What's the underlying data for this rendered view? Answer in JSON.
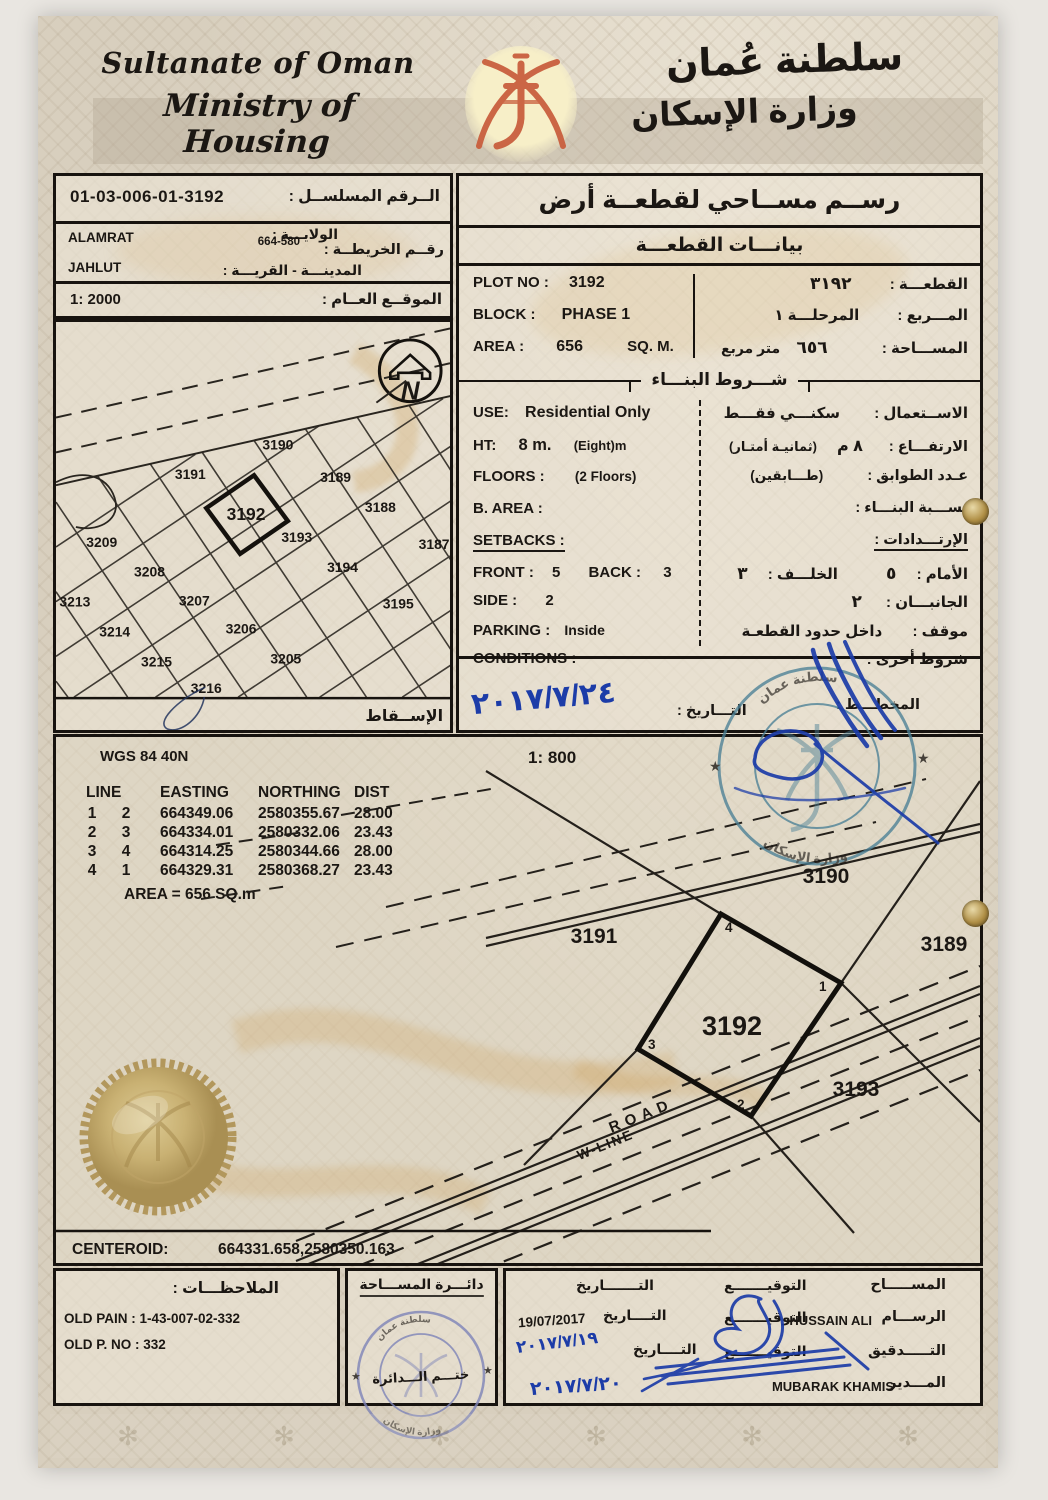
{
  "decor": {
    "star": "★",
    "watermark_glyph": "✻"
  },
  "header": {
    "en_line1": "Sultanate of Oman",
    "en_line2": "Ministry of Housing",
    "ar_line1": "سلطنة عُمان",
    "ar_line2": "وزارة الإسكان"
  },
  "serial_box": {
    "serial_value": "01-03-006-01-3192",
    "serial_label": "الــرقم المسلســل :",
    "wilaya_value": "ALAMRAT",
    "wilaya_label": "الولايـــة :",
    "map_value": "664-580",
    "map_label": "رقــم الخريطــة :",
    "city_value": "JAHLUT",
    "city_label": "المدينـــة - القريـــة :",
    "site_value": "1: 2000",
    "site_label": "الموقــع العــام :"
  },
  "location_map": {
    "plots": [
      "3190",
      "3191",
      "3189",
      "3192",
      "3188",
      "3209",
      "3193",
      "3187",
      "3208",
      "3194",
      "3213",
      "3207",
      "3195",
      "3214",
      "3206",
      "3215",
      "3205",
      "3216"
    ],
    "north": "N",
    "projection_label": "الإســقاط"
  },
  "plot_info": {
    "title": "رســم مســاحي لقطعــة أرض",
    "subtitle": "بيانـــات القطعـــة",
    "plot_no_label": "PLOT NO :",
    "plot_no_value": "3192",
    "plot_ar_label": "القطعـــة :",
    "plot_ar_value": "٣١٩٢",
    "block_label": "BLOCK :",
    "block_value": "PHASE 1",
    "block_ar_label": "المـــربع :",
    "block_ar_value": "المرحلـــة ١",
    "area_label": "AREA :",
    "area_value": "656",
    "area_unit": "SQ. M.",
    "area_ar_label": "المســـاحة :",
    "area_ar_value": "٦٥٦",
    "area_ar_unit": "متر مربع",
    "conditions_title": "شـــروط البنـــاء",
    "use_label": "USE:",
    "use_value": "Residential Only",
    "use_ar_label": "الاســتعمال :",
    "use_ar_value": "سكنـــي فقـــط",
    "ht_label": "HT:",
    "ht_value": "8 m.",
    "ht_note": "(Eight)m",
    "ht_ar_label": "الارتفـــاع :",
    "ht_ar_value": "٨ م",
    "ht_ar_note": "(ثمانيـة أمتـار)",
    "floors_label": "FLOORS :",
    "floors_value": "(2 Floors)",
    "floors_ar_label": "عـدد الطوابق :",
    "floors_ar_value": "(طـــابقين)",
    "barea_label": "B. AREA :",
    "barea_ar_label": "نســـبة البنـــاء :",
    "setbacks_label": "SETBACKS :",
    "setbacks_ar_label": "الإرتـــدادات :",
    "front_label": "FRONT :",
    "front_value": "5",
    "back_label": "BACK :",
    "back_value": "3",
    "front_ar_label": "الأمام :",
    "front_ar_value": "٥",
    "back_ar_label": "الخلـــف :",
    "back_ar_value": "٣",
    "side_label": "SIDE :",
    "side_value": "2",
    "side_ar_label": "الجانبـــان :",
    "side_ar_value": "٢",
    "parking_label": "PARKING :",
    "parking_value": "Inside",
    "parking_ar_label": "موقف :",
    "parking_ar_value": "داخل حدود القطعـة",
    "cond_label": "CONDITIONS :",
    "cond_ar_label": "شروط أخرى :",
    "date_label": "التـــاريخ :",
    "hand_date": "٢٠١٧/٧/٢٤",
    "planner_label": "المخطـــط :"
  },
  "survey": {
    "datum": "WGS 84  40N",
    "scale": "1: 800",
    "col_line": "LINE",
    "col_easting": "EASTING",
    "col_northing": "NORTHING",
    "col_dist": "DIST",
    "rows": [
      [
        "1",
        "2",
        "664349.06",
        "2580355.67",
        "28.00"
      ],
      [
        "2",
        "3",
        "664334.01",
        "2580332.06",
        "23.43"
      ],
      [
        "3",
        "4",
        "664314.25",
        "2580344.66",
        "28.00"
      ],
      [
        "4",
        "1",
        "664329.31",
        "2580368.27",
        "23.43"
      ]
    ],
    "area_note": "AREA = 656  SQ.m",
    "plot_label": "3192",
    "corner1": "1",
    "corner2": "2",
    "corner3": "3",
    "corner4": "4",
    "neighbor_top": "3190",
    "neighbor_left": "3191",
    "neighbor_right": "3189",
    "neighbor_bottom": "3193",
    "road_label": "ROAD",
    "wline_label": "W-LINE",
    "centeroid_label": "CENTEROID:",
    "centeroid_value": "664331.658,2580350.163"
  },
  "stamps": {
    "ring_top": "سلطنة عمان",
    "ring_bottom": "وزارة الإسكان"
  },
  "notes_box": {
    "title": "الملاحظـــات :",
    "line1": "OLD PAIN : 1-43-007-02-332",
    "line2": "OLD P. NO : 332"
  },
  "dept_box": {
    "title": "دائـــرة المســـاحة",
    "stamp_text": "ختـــم الـــدائرة"
  },
  "signatures": {
    "surveyor_label": "المســـــاح",
    "draftsman_label": "الرســـام",
    "audit_label": "التـــــدقيق",
    "manager_label": "المـــدير",
    "sign_label": "التوقيـــــــع",
    "date_label": "التـــــــاريخ",
    "date_label_short": "التــــاريخ",
    "draftsman_name": "HUSSAIN ALI",
    "manager_name": "MUBARAK KHAMIS",
    "printed_date": "19/07/2017",
    "hand_date1": "٢٠١٧/٧/١٩",
    "hand_date2": "٢٠١٧/٧/٢٠"
  }
}
